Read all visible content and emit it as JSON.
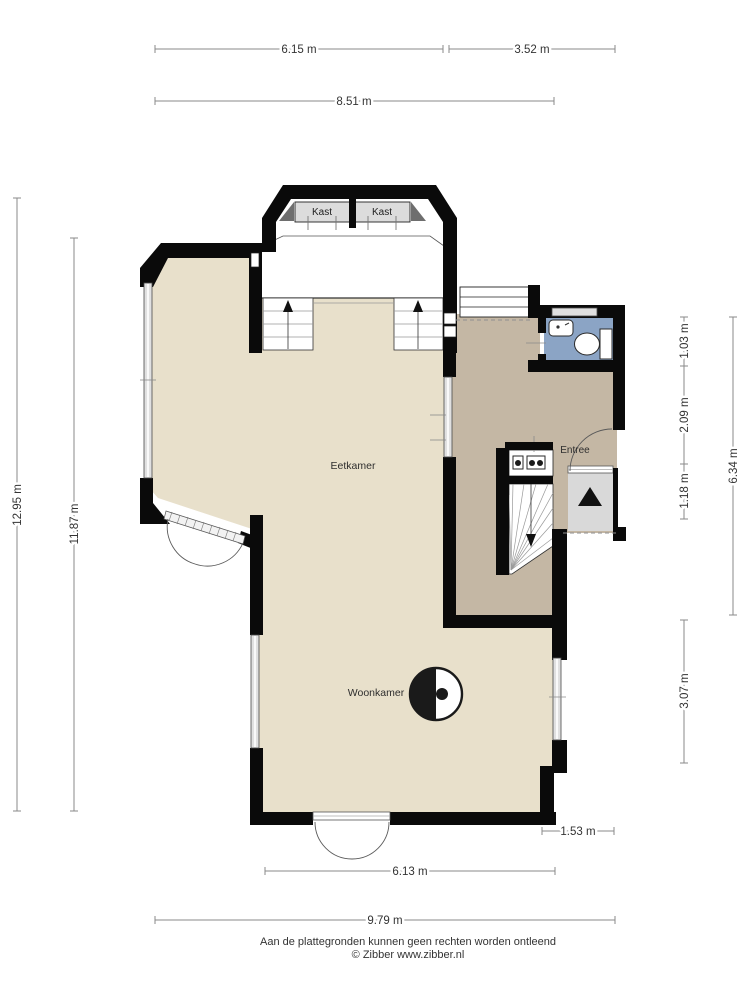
{
  "plan": {
    "type": "floor-plan",
    "floor": "begane grond",
    "rooms": {
      "closet_left": "Kast",
      "closet_right": "Kast",
      "dining": "Eetkamer",
      "living": "Woonkamer",
      "entry": "Entree"
    },
    "dimensions": {
      "top": [
        "6.15 m",
        "3.52 m",
        "8.51 m"
      ],
      "left": [
        "12.95 m",
        "11.87 m"
      ],
      "right": [
        "1.03 m",
        "2.09 m",
        "1.18 m",
        "6.34 m",
        "3.07 m"
      ],
      "bottom": [
        "1.53 m",
        "6.13 m",
        "9.79 m"
      ]
    },
    "footer": {
      "disclaimer": "Aan de plattegronden kunnen geen rechten worden ontleend",
      "copyright": "© Zibber www.zibber.nl"
    },
    "colors": {
      "floor_beige": "#e8e0cb",
      "hall_taupe": "#c4b7a4",
      "toilet_blue": "#8ba4c5",
      "closet_grey": "#dcdcdc",
      "mat_grey": "#d9d9d9",
      "corner_dark_grey": "#6e6e6e",
      "wall_black": "#0a0a0a",
      "dimension_grey": "#8a8a8a"
    },
    "icons": {
      "stove_icon": "half-filled circle with dot",
      "toilet_icon": "toilet bowl with cistern",
      "sink_icon": "small basin",
      "entrance_arrow_icon": "solid triangle up",
      "stairs_up_arrow_icon": "triangle up with line",
      "stairs_down_arrow_icon": "triangle down with line",
      "meter_cupboard_icon": "boxes with circles"
    }
  }
}
